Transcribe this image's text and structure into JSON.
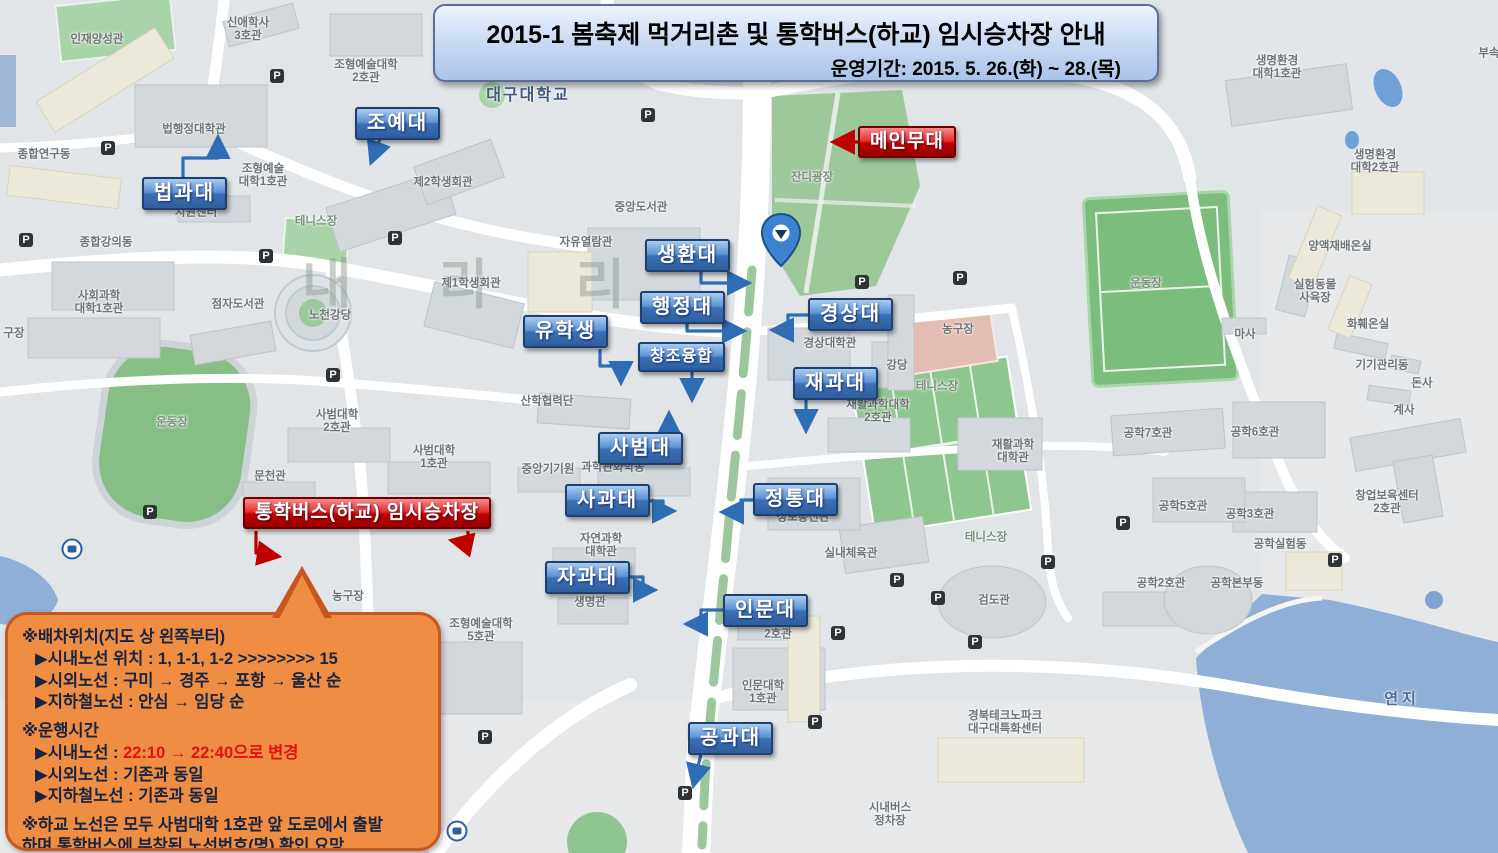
{
  "banner": {
    "title": "2015-1 봄축제 먹거리촌 및 통학버스(하교) 임시승차장 안내",
    "subtitle": "운영기간: 2015. 5. 26.(화) ~ 28.(목)"
  },
  "callouts": {
    "blue": [
      {
        "label": "조예대",
        "x": 355,
        "y": 107
      },
      {
        "label": "법과대",
        "x": 142,
        "y": 177
      },
      {
        "label": "생환대",
        "x": 645,
        "y": 239
      },
      {
        "label": "행정대",
        "x": 640,
        "y": 291
      },
      {
        "label": "경상대",
        "x": 808,
        "y": 298
      },
      {
        "label": "유학생",
        "x": 523,
        "y": 315
      },
      {
        "label": "창조융합",
        "x": 638,
        "y": 342,
        "cls": "small"
      },
      {
        "label": "재과대",
        "x": 793,
        "y": 367
      },
      {
        "label": "사범대",
        "x": 598,
        "y": 432
      },
      {
        "label": "사과대",
        "x": 565,
        "y": 484
      },
      {
        "label": "정통대",
        "x": 753,
        "y": 483
      },
      {
        "label": "자과대",
        "x": 545,
        "y": 561
      },
      {
        "label": "인문대",
        "x": 723,
        "y": 594
      },
      {
        "label": "공과대",
        "x": 688,
        "y": 722
      }
    ],
    "red": [
      {
        "label": "메인무대",
        "x": 858,
        "y": 126
      },
      {
        "label": "통학버스(하교) 임시승차장",
        "x": 243,
        "y": 497
      }
    ]
  },
  "notice": {
    "sections": [
      {
        "lines": [
          "※배차위치(지도 상 왼쪽부터)"
        ],
        "items": [
          {
            "text": "▶시내노선 위치 : 1, 1-1, 1-2 >>>>>>>> 15"
          },
          {
            "text": "▶시외노선 : 구미 → 경주 → 포항 → 울산 순"
          },
          {
            "text": "▶지하철노선 : 안심 → 임당 순"
          }
        ]
      },
      {
        "lines": [
          "※운행시간"
        ],
        "items": [
          {
            "prefix": "▶시내노선 : ",
            "highlight": "22:10 → 22:40으로 변경"
          },
          {
            "text": "▶시외노선 : 기존과 동일"
          },
          {
            "text": "▶지하철노선 : 기존과 동일"
          }
        ]
      },
      {
        "lines": [
          "※하교 노선은 모두 사범대학 1호관 앞 도로에서 출발",
          "하며 통학버스에 부착된 노선번호(명) 확인 요망"
        ],
        "items": []
      }
    ]
  },
  "map": {
    "watermark": "내 리 리",
    "parking_glyph": "P",
    "labels": [
      {
        "text": "신애학사\n3호관",
        "x": 248,
        "y": 30
      },
      {
        "text": "인재양성관",
        "x": 97,
        "y": 40
      },
      {
        "text": "조형예술대학\n2호관",
        "x": 366,
        "y": 72
      },
      {
        "text": "대구대학교",
        "x": 528,
        "y": 96,
        "cls": "univ"
      },
      {
        "text": "종합연구동",
        "x": 44,
        "y": 155
      },
      {
        "text": "법행정대학관",
        "x": 194,
        "y": 130
      },
      {
        "text": "조형예술\n대학1호관",
        "x": 263,
        "y": 176
      },
      {
        "text": "지원센터",
        "x": 196,
        "y": 213
      },
      {
        "text": "제2학생회관",
        "x": 443,
        "y": 183
      },
      {
        "text": "테니스장",
        "x": 316,
        "y": 222,
        "cls": "green-label"
      },
      {
        "text": "종합강의동",
        "x": 106,
        "y": 243
      },
      {
        "text": "사회과학\n대학1호관",
        "x": 99,
        "y": 303
      },
      {
        "text": "점자도서관",
        "x": 238,
        "y": 305
      },
      {
        "text": "노천강당",
        "x": 330,
        "y": 316
      },
      {
        "text": "제1학생회관",
        "x": 471,
        "y": 284
      },
      {
        "text": "자유열람관",
        "x": 586,
        "y": 243
      },
      {
        "text": "중앙도서관",
        "x": 641,
        "y": 208
      },
      {
        "text": "잔디광장",
        "x": 812,
        "y": 178,
        "cls": "green-label"
      },
      {
        "text": "경상대학관",
        "x": 830,
        "y": 344
      },
      {
        "text": "강당",
        "x": 897,
        "y": 366
      },
      {
        "text": "농구장",
        "x": 958,
        "y": 330
      },
      {
        "text": "테니스장",
        "x": 937,
        "y": 387,
        "cls": "green-label"
      },
      {
        "text": "테니스장",
        "x": 986,
        "y": 538,
        "cls": "green-label"
      },
      {
        "text": "재활과학대학\n2호관",
        "x": 878,
        "y": 412
      },
      {
        "text": "재활과학\n대학관",
        "x": 1013,
        "y": 452
      },
      {
        "text": "운동장",
        "x": 1146,
        "y": 284,
        "cls": "field-label"
      },
      {
        "text": "운동장",
        "x": 172,
        "y": 423,
        "cls": "field-label"
      },
      {
        "text": "마사",
        "x": 1245,
        "y": 335
      },
      {
        "text": "양액재배온실",
        "x": 1340,
        "y": 247
      },
      {
        "text": "실험동물\n사육장",
        "x": 1315,
        "y": 292
      },
      {
        "text": "화훼온실",
        "x": 1368,
        "y": 325
      },
      {
        "text": "기기관리동",
        "x": 1382,
        "y": 366
      },
      {
        "text": "돈사",
        "x": 1422,
        "y": 384
      },
      {
        "text": "계사",
        "x": 1404,
        "y": 411
      },
      {
        "text": "생명환경\n대학1호관",
        "x": 1277,
        "y": 68
      },
      {
        "text": "생명환경\n대학2호관",
        "x": 1375,
        "y": 162
      },
      {
        "text": "부속",
        "x": 1489,
        "y": 54
      },
      {
        "text": "공학7호관",
        "x": 1148,
        "y": 434
      },
      {
        "text": "공학6호관",
        "x": 1255,
        "y": 433
      },
      {
        "text": "공학5호관",
        "x": 1183,
        "y": 507
      },
      {
        "text": "공학3호관",
        "x": 1250,
        "y": 515
      },
      {
        "text": "창업보육센터\n2호관",
        "x": 1387,
        "y": 503
      },
      {
        "text": "공학실험동",
        "x": 1280,
        "y": 545
      },
      {
        "text": "공학2호관",
        "x": 1161,
        "y": 584
      },
      {
        "text": "공학본부동",
        "x": 1237,
        "y": 584
      },
      {
        "text": "검도관",
        "x": 994,
        "y": 601
      },
      {
        "text": "경북테크노파크\n대구대특화센터",
        "x": 1005,
        "y": 723
      },
      {
        "text": "시내버스\n정차장",
        "x": 890,
        "y": 815
      },
      {
        "text": "연지",
        "x": 1402,
        "y": 700,
        "cls": "water-label"
      },
      {
        "text": "인문대학\n1호관",
        "x": 763,
        "y": 693
      },
      {
        "text": "2호관",
        "x": 778,
        "y": 635
      },
      {
        "text": "실내체육관",
        "x": 851,
        "y": 554
      },
      {
        "text": "정보통신관",
        "x": 803,
        "y": 518
      },
      {
        "text": "자연과학\n대학관",
        "x": 601,
        "y": 546
      },
      {
        "text": "생명관",
        "x": 590,
        "y": 603
      },
      {
        "text": "조형예술대학\n5호관",
        "x": 481,
        "y": 631
      },
      {
        "text": "과학관화학동",
        "x": 613,
        "y": 468
      },
      {
        "text": "중앙기기원",
        "x": 548,
        "y": 470
      },
      {
        "text": "사범대학\n2호관",
        "x": 337,
        "y": 422
      },
      {
        "text": "사범대학\n1호관",
        "x": 434,
        "y": 458
      },
      {
        "text": "산학협력단",
        "x": 547,
        "y": 402
      },
      {
        "text": "문천관",
        "x": 270,
        "y": 477
      },
      {
        "text": "농구장",
        "x": 348,
        "y": 597
      },
      {
        "text": "구장",
        "x": 14,
        "y": 334
      }
    ],
    "parking_icons": [
      {
        "x": 108,
        "y": 148
      },
      {
        "x": 277,
        "y": 76
      },
      {
        "x": 26,
        "y": 240
      },
      {
        "x": 266,
        "y": 256
      },
      {
        "x": 395,
        "y": 238
      },
      {
        "x": 333,
        "y": 375
      },
      {
        "x": 150,
        "y": 512
      },
      {
        "x": 485,
        "y": 737
      },
      {
        "x": 648,
        "y": 115
      },
      {
        "x": 862,
        "y": 282
      },
      {
        "x": 960,
        "y": 278
      },
      {
        "x": 897,
        "y": 580
      },
      {
        "x": 938,
        "y": 598
      },
      {
        "x": 975,
        "y": 642
      },
      {
        "x": 1048,
        "y": 562
      },
      {
        "x": 1123,
        "y": 523
      },
      {
        "x": 1335,
        "y": 560
      },
      {
        "x": 815,
        "y": 722
      },
      {
        "x": 685,
        "y": 793
      },
      {
        "x": 838,
        "y": 633
      }
    ],
    "bus_icons": [
      {
        "x": 72,
        "y": 549
      },
      {
        "x": 457,
        "y": 831
      }
    ]
  },
  "theme": {
    "callout_blue": "#3A70B5",
    "callout_red": "#C00000",
    "bubble_orange": "#EF8D43",
    "banner_blue": "#CBDCF5",
    "highlight_red": "#E31212"
  }
}
